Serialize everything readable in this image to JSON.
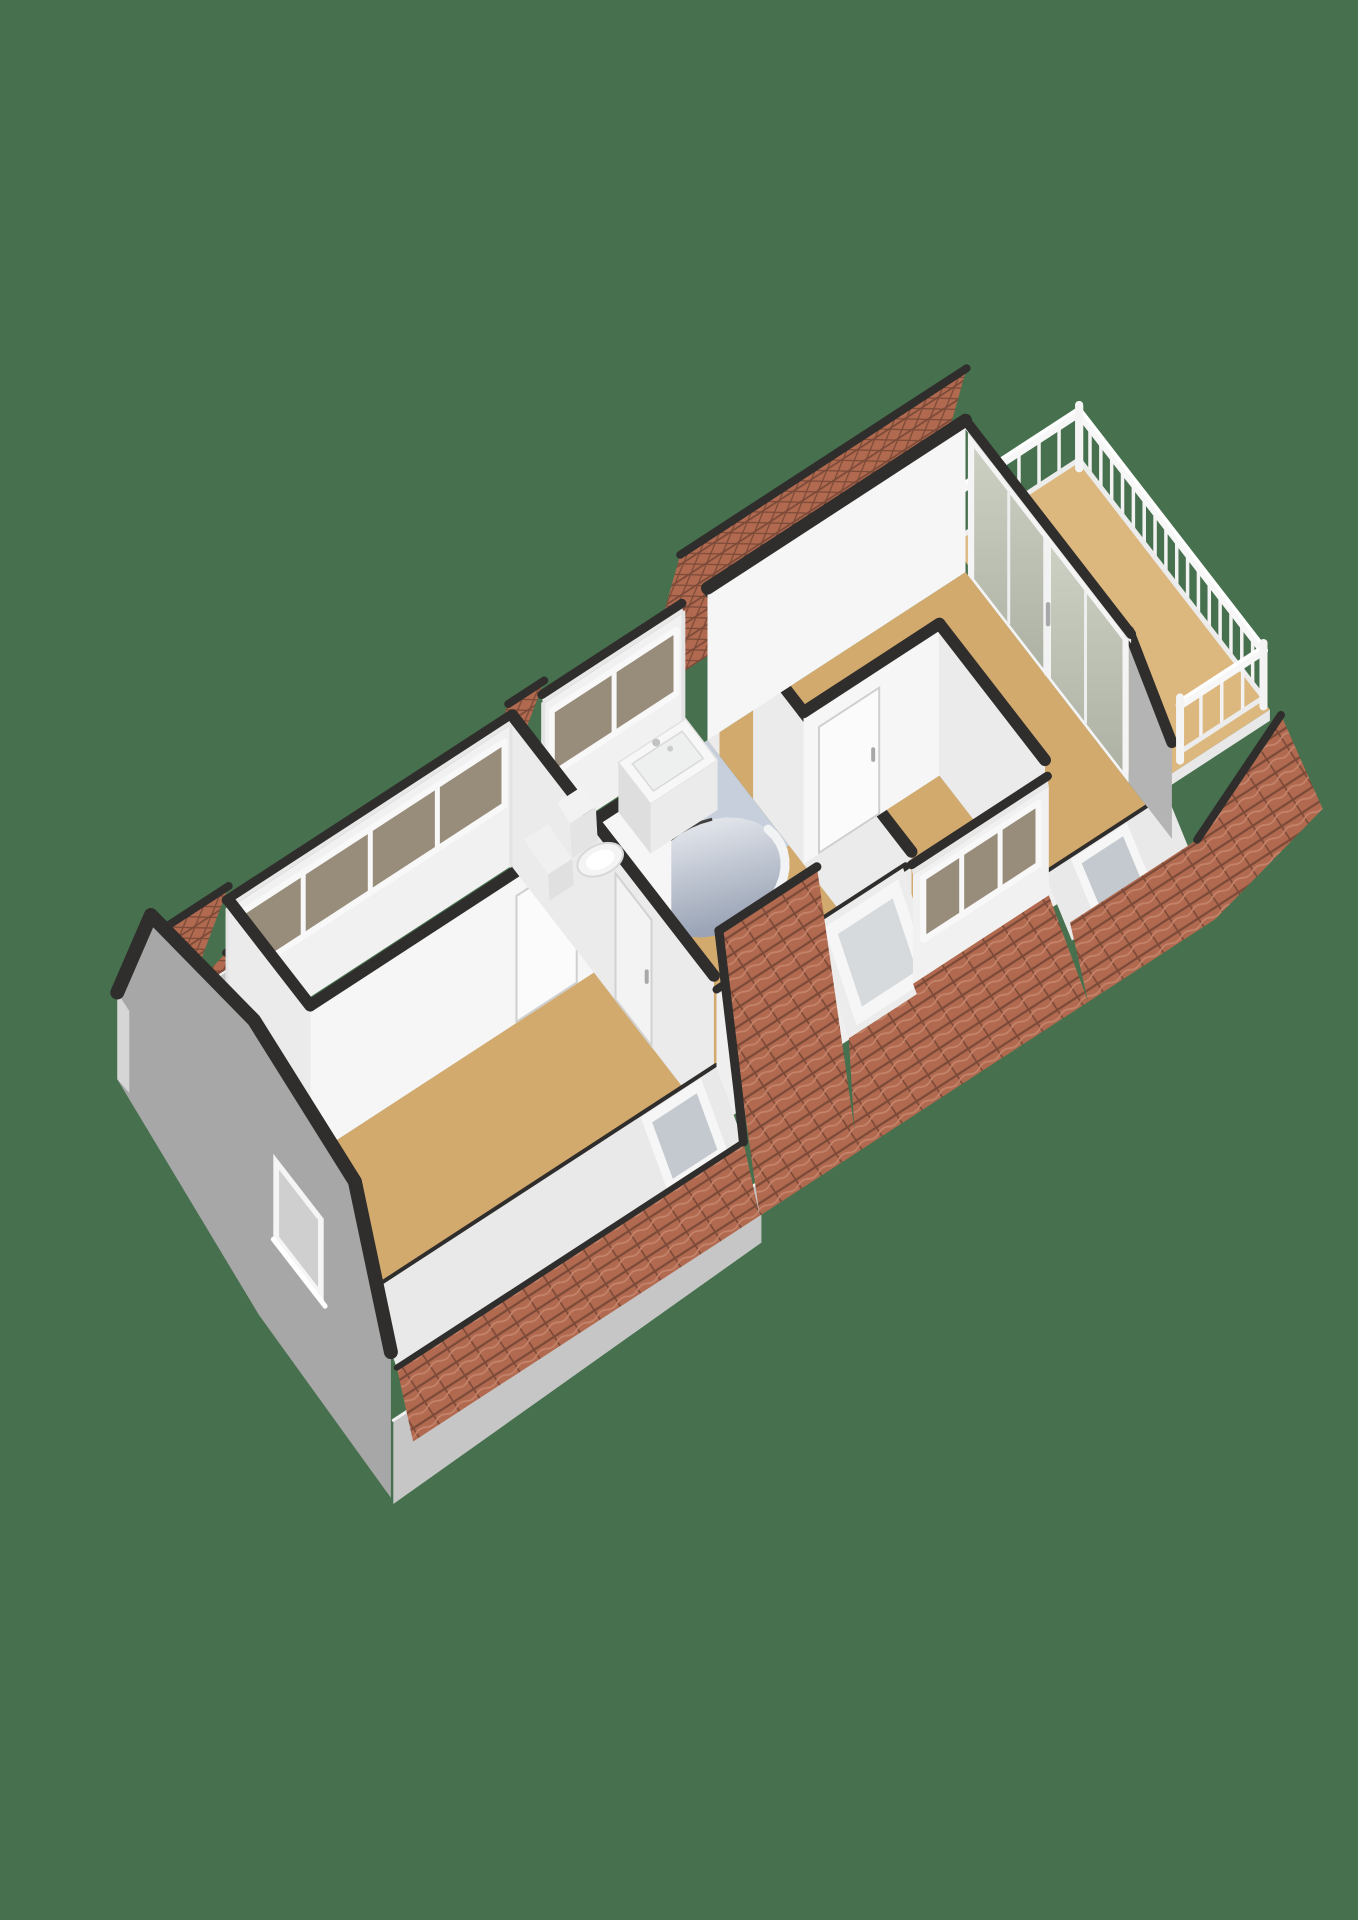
{
  "image": {
    "kind": "3d-floorplan-render",
    "storey": "attic floor",
    "background": "#47714e"
  },
  "colors": {
    "bg": "#47714e",
    "floorWood": "#d3aa6e",
    "floorWoodLight": "#dcb77e",
    "floorBath": "#c6cfdb",
    "wallWhite": "#f6f6f6",
    "wallShade": "#ebebeb",
    "wallDim": "#e2e2e2",
    "kneeWhite": "#efefef",
    "wallExt": "#a7a7a7",
    "wallExtLight": "#c6c6c6",
    "wallExtDark": "#939393",
    "cap": "#2f2e2c",
    "tile": "#b16a4f",
    "tileDark": "#7c4a38",
    "tileLight": "#c4836a",
    "frame": "#f8f8f8",
    "frameShade": "#e6e6e6",
    "glassWarm": "#988c7b",
    "glassCoolA": "#ccd0c3",
    "glassCoolB": "#adb2a5",
    "glassSky": "#d7dadd",
    "voidLight": "#eef0f4",
    "voidDark": "#9aa4b6",
    "fixture": "#f4f4f4",
    "fixtureShade": "#dedede",
    "handle": "#a8a8a8"
  },
  "structure": {
    "roof": {
      "style": "mansard",
      "tiles": "orange-red",
      "cut_walls": "dark-capped"
    },
    "rooms": [
      {
        "name": "bedroom-left",
        "floor": "wood",
        "features": [
          "band-window-dormer",
          "door"
        ]
      },
      {
        "name": "bedroom-bottom",
        "floor": "wood",
        "features": [
          "gable-window",
          "roof-skylight",
          "doors"
        ]
      },
      {
        "name": "bathroom",
        "floor": "light-blue",
        "fixtures": [
          "toilet",
          "washbasin",
          "cabinet"
        ],
        "features": [
          "band-window-dormer",
          "curved-stairwell"
        ]
      },
      {
        "name": "landing",
        "floor": "wood",
        "features": [
          "large-roof-skylight"
        ]
      },
      {
        "name": "bedroom-right",
        "floor": "wood",
        "features": [
          "band-window-dormer",
          "door"
        ]
      },
      {
        "name": "living-room",
        "floor": "wood",
        "features": [
          "sliding-glass-doors",
          "roof-skylight",
          "door-opening"
        ]
      },
      {
        "name": "balcony",
        "floor": "wood",
        "features": [
          "white-balustrade"
        ]
      }
    ]
  }
}
